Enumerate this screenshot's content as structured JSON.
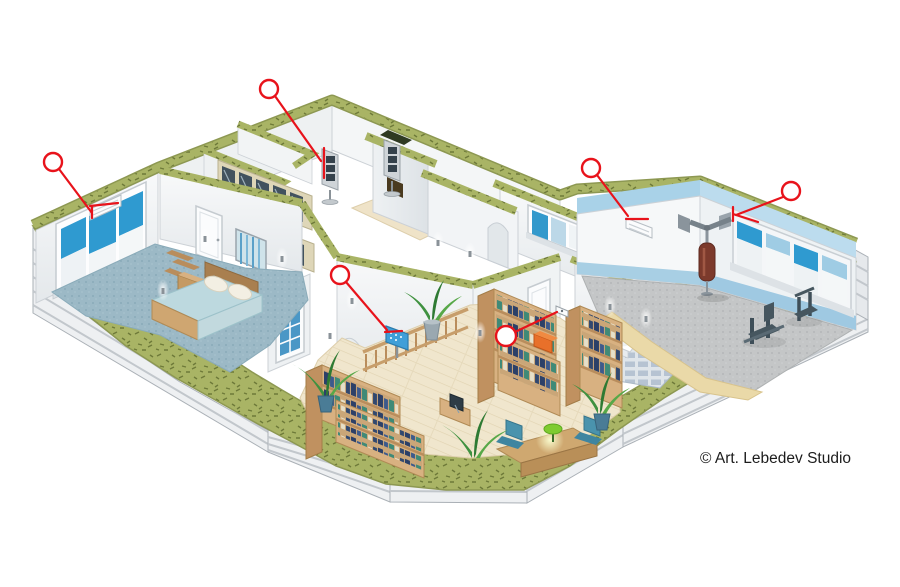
{
  "image": {
    "kind": "isometric-cutaway-house-illustration",
    "width": 900,
    "height": 587,
    "background": "#ffffff"
  },
  "credit": {
    "text": "© Art. Lebedev Studio",
    "color": "#1c1c1c",
    "x": 700,
    "y": 463
  },
  "palette": {
    "annotation_red": "#e8131b",
    "cut_wall_green": "#a9b465",
    "cut_wall_speckle": "#6e7a39",
    "siding_gray": "#eef0f2",
    "siding_stripe": "#c2c7cc",
    "wall_light": "#f6f8f9",
    "window_blue": "#2f9ad0",
    "gym_ceiling_blue": "#a9d2e8",
    "bedroom_carpet_blue": "#9cb9c6",
    "gym_carpet_gray": "#c4c6c7",
    "library_floor_tan": "#f0e6cd",
    "shelf_wood": "#d8b181",
    "book_navy": "#2c4068",
    "book_teal": "#3f8a77",
    "plant_green": "#3f9140",
    "punching_bag_brown": "#7c3a2c",
    "lamp_green": "#7fcb30",
    "orange_box": "#e8702a"
  },
  "annotations": {
    "color": "#e8131b",
    "callouts": [
      {
        "name": "bedroom-window-vent",
        "circle": [
          53,
          162,
          9
        ],
        "lines": [
          [
            59,
            169,
            92,
            213
          ],
          [
            90,
            206,
            118,
            203
          ],
          [
            92,
            206,
            92,
            218
          ]
        ]
      },
      {
        "name": "floor-speakers",
        "circle": [
          269,
          89,
          9
        ],
        "lines": [
          [
            275,
            96,
            321,
            161
          ],
          [
            324,
            148,
            324,
            178
          ]
        ]
      },
      {
        "name": "gym-air-conditioner",
        "circle": [
          591,
          168,
          9
        ],
        "lines": [
          [
            597,
            175,
            628,
            216
          ],
          [
            626,
            219,
            648,
            219
          ]
        ]
      },
      {
        "name": "gym-window-ventilator",
        "circle": [
          791,
          191,
          9
        ],
        "lines": [
          [
            783,
            197,
            736,
            215
          ],
          [
            733,
            207,
            733,
            221
          ],
          [
            733,
            214,
            758,
            222
          ]
        ]
      },
      {
        "name": "library-info-screen",
        "circle": [
          340,
          275,
          9
        ],
        "lines": [
          [
            346,
            282,
            387,
            330
          ],
          [
            385,
            332,
            402,
            331
          ]
        ]
      },
      {
        "name": "wireless-sensor",
        "circle": [
          506,
          336,
          10
        ],
        "lines": [
          [
            515,
            332,
            557,
            312
          ]
        ]
      }
    ]
  }
}
